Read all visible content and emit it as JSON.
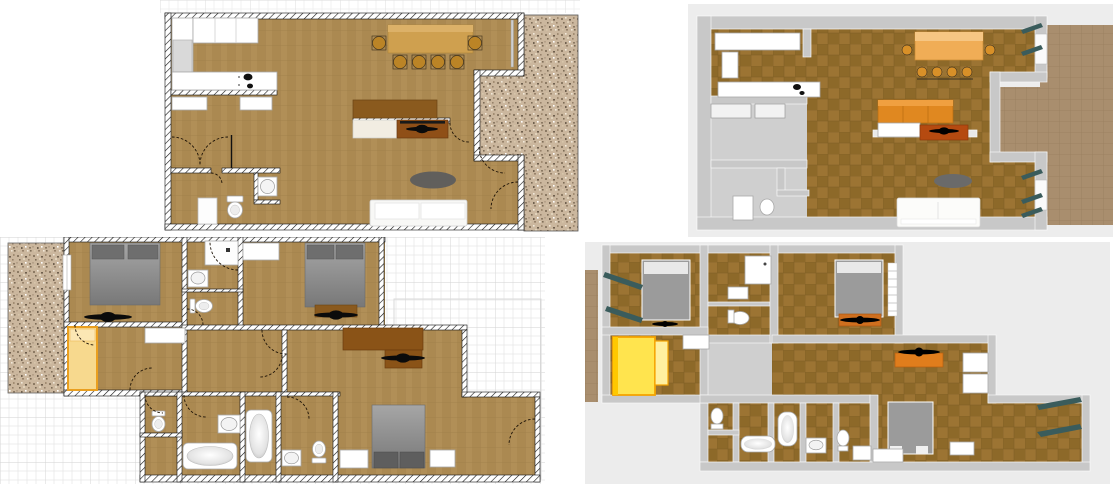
{
  "document": {
    "title": "Two-storey house floor plans",
    "description": "Four views: 2D plan and 3D aerial view of the ground floor (top), 2D plan and 3D aerial view of the upper floor (bottom)",
    "background": "#ffffff"
  },
  "panels": [
    {
      "id": "ground-2d",
      "label": "Ground floor 2D plan",
      "view": "2d-plan",
      "floor": "ground"
    },
    {
      "id": "ground-3d",
      "label": "Ground floor 3D aerial view",
      "view": "3d-aerial",
      "floor": "ground"
    },
    {
      "id": "upper-2d",
      "label": "Upper floor 2D plan",
      "view": "2d-plan",
      "floor": "upper"
    },
    {
      "id": "upper-3d",
      "label": "Upper floor 3D aerial view",
      "view": "3d-aerial",
      "floor": "upper"
    }
  ],
  "palette": {
    "plan_floor": "#b18f57",
    "plan_floor_line": "#9f7f4a",
    "wall_hatch": "#111111",
    "gravel_base": "#cbb79e",
    "graph_grid_minor": "#e7e7e7",
    "graph_grid_major": "#d2d2d2",
    "wall_3d": "#c8c8c8",
    "floor_3d": "#9c7433",
    "floor_3d_check": "#8d6929",
    "background_3d": "#ededed",
    "terrace_3d": "#a98e6e",
    "shutter_teal": "#3a5c5c",
    "table_tan_2d": "#cfa04f",
    "table_orange_3d": "#f0ad56",
    "chair_gold": "#bb8426",
    "sideboard_brown_2d": "#8a5a1e",
    "sideboard_orange_3d": "#e08820",
    "tv_cabinet_brown": "#8f4f17",
    "bed_gray": "#8b8b8b",
    "pillow_dark_gray": "#6e6e6e",
    "single_bed_yellow_2d": "#f7d98e",
    "single_bed_frame_2d": "#ea9f1f",
    "single_bed_yellow_3d": "#ffe44e",
    "desk_brown": "#8a5317",
    "rug_gray": "#5d5d5d",
    "sofa_white": "#f8f8f6",
    "fan_black": "#0b0b0b",
    "fixture_white": "#ffffff"
  },
  "ground_floor": {
    "rooms": [
      "kitchen",
      "living room",
      "dining area",
      "hallway",
      "wc",
      "terrace"
    ],
    "furniture": [
      {
        "item": "refrigerator",
        "color": "#d9d9d9"
      },
      {
        "item": "kitchen cabinets",
        "color": "#f5f5f2"
      },
      {
        "item": "countertop with cooktop",
        "color": "#111111"
      },
      {
        "item": "dining table",
        "color": "#cfa04f"
      },
      {
        "item": "dining chair",
        "count": 6,
        "color": "#bb8426"
      },
      {
        "item": "sideboard",
        "color": "#8a5a1e"
      },
      {
        "item": "tv lowboard",
        "color": "#8f4f17"
      },
      {
        "item": "ceiling fan",
        "count": 1,
        "color": "#0b0b0b"
      },
      {
        "item": "rug",
        "color": "#5d5d5d"
      },
      {
        "item": "sofa",
        "color": "#f8f8f6"
      },
      {
        "item": "washing machine",
        "color": "#ffffff"
      },
      {
        "item": "toilet",
        "count": 1,
        "color": "#ffffff"
      },
      {
        "item": "washbasin",
        "count": 1,
        "color": "#ffffff"
      }
    ]
  },
  "upper_floor": {
    "rooms": [
      "bedroom 1",
      "bedroom 2",
      "bedroom 3",
      "kids room",
      "shower room",
      "wc",
      "bathroom",
      "hallway",
      "balcony"
    ],
    "furniture": [
      {
        "item": "double bed",
        "count": 3,
        "color": "#8b8b8b"
      },
      {
        "item": "single bed",
        "count": 1,
        "color": "#f7d98e"
      },
      {
        "item": "ceiling fan",
        "count": 3,
        "color": "#0b0b0b"
      },
      {
        "item": "desk",
        "color": "#8a5317"
      },
      {
        "item": "shower tray",
        "count": 1,
        "color": "#ffffff"
      },
      {
        "item": "bathtub",
        "count": 2,
        "color": "#ffffff"
      },
      {
        "item": "toilet",
        "count": 3,
        "color": "#ffffff"
      },
      {
        "item": "washbasin",
        "count": 3,
        "color": "#ffffff"
      },
      {
        "item": "wardrobe shelf",
        "count": 4,
        "color": "#ffffff"
      },
      {
        "item": "nightstand",
        "count": 2,
        "color": "#ffffff"
      }
    ]
  }
}
